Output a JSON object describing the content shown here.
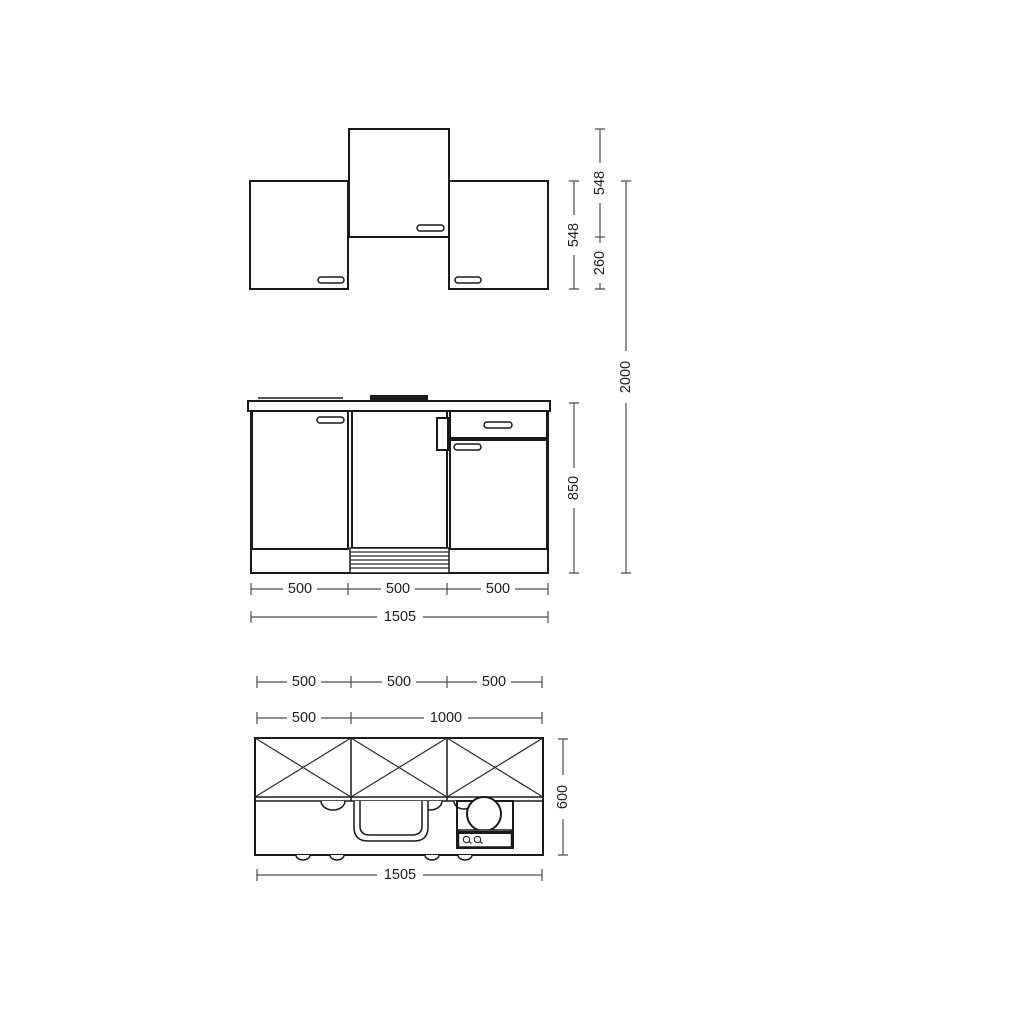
{
  "drawing": {
    "background_color": "#ffffff",
    "outline_color": "#1a1a1a",
    "dimension_color": "#4d4d4d",
    "wall_elevation": {
      "side_cabinet_height": "548",
      "middle_cabinet_height": "548",
      "middle_cabinet_offset": "260",
      "overall_height": "2000"
    },
    "base_elevation": {
      "unit_widths": [
        "500",
        "500",
        "500"
      ],
      "overall_width": "1505",
      "worktop_height": "850"
    },
    "plan": {
      "unit_widths": [
        "500",
        "500",
        "500"
      ],
      "left_segment_width": "500",
      "right_segment_width": "1000",
      "depth": "600",
      "overall_width": "1505"
    }
  }
}
